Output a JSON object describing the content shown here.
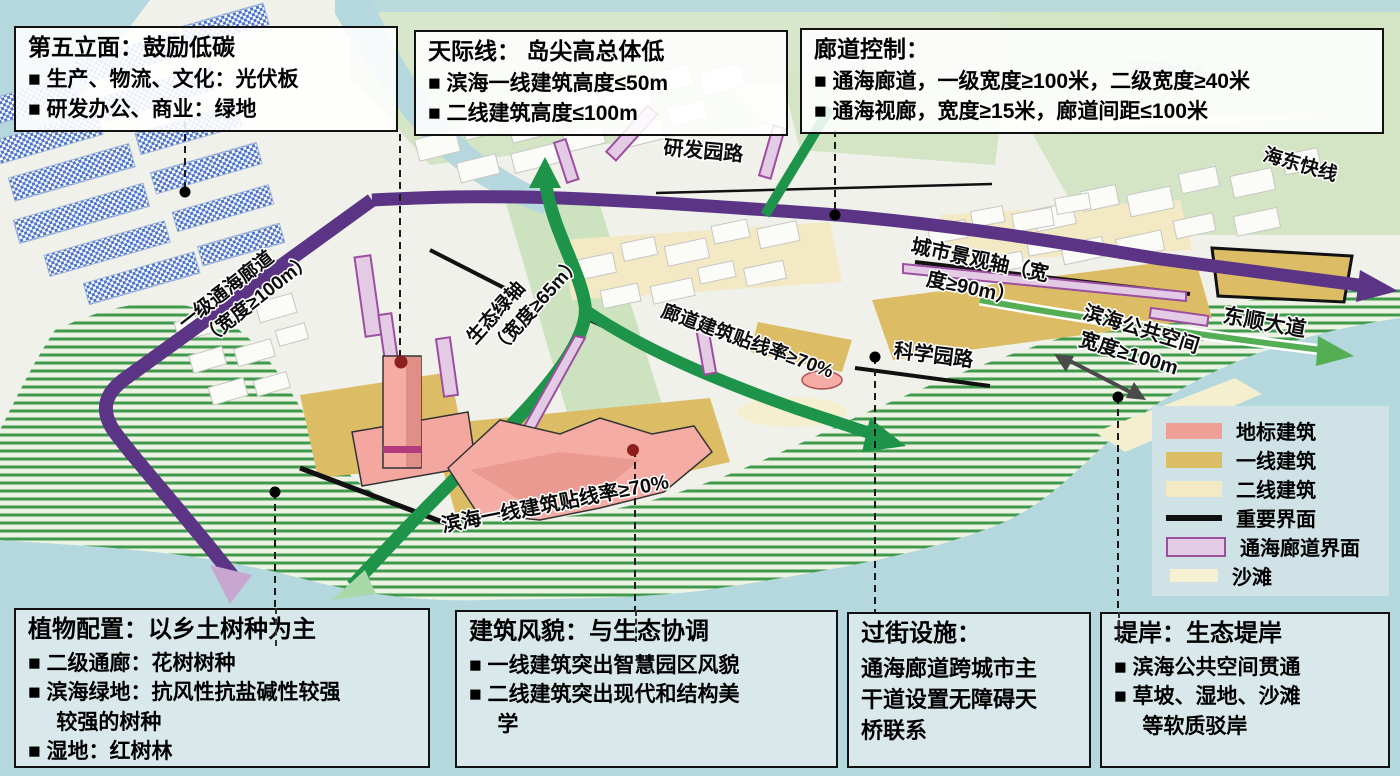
{
  "callouts": {
    "facade": {
      "title": "第五立面：鼓励低碳",
      "items": [
        "■ 生产、物流、文化：光伏板",
        "■ 研发办公、商业：绿地"
      ]
    },
    "skyline": {
      "title": "天际线： 岛尖高总体低",
      "items": [
        "■ 滨海一线建筑高度≤50m",
        "■ 二线建筑高度≤100m"
      ]
    },
    "corridor": {
      "title": "廊道控制：",
      "items": [
        "■ 通海廊道，一级宽度≥100米，二级宽度≥40米",
        "■ 通海视廊，宽度≥15米，廊道间距≤100米"
      ]
    },
    "plants": {
      "title": "植物配置：以乡土树种为主",
      "items": [
        "■ 二级通廊：花树树种",
        "■ 滨海绿地：抗风性抗盐碱性较强\n较强的树种",
        "■ 湿地：红树林"
      ]
    },
    "style": {
      "title": "建筑风貌：与生态协调",
      "items": [
        "■ 一线建筑突出智慧园区风貌",
        "■ 二线建筑突出现代和结构美\n学"
      ]
    },
    "crossing": {
      "title": "过街设施：",
      "body": "通海廊道跨城市主\n干道设置无障碍天\n桥联系"
    },
    "embankment": {
      "title": "堤岸：生态堤岸",
      "items": [
        "■ 滨海公共空间贯通",
        "■ 草坡、湿地、沙滩\n等软质驳岸"
      ]
    }
  },
  "legend": {
    "items": [
      {
        "label": "地标建筑",
        "color": "#ef9f96"
      },
      {
        "label": "一线建筑",
        "color": "#dcbd66"
      },
      {
        "label": "二线建筑",
        "color": "#f4e9c5"
      },
      {
        "label": "重要界面",
        "color": "#111111"
      },
      {
        "label": "通海廊道界面",
        "color": "#e3cbe6",
        "border": "#9c4f9e"
      },
      {
        "label": "沙滩",
        "color": "#f5f1d2"
      }
    ]
  },
  "map_labels": {
    "corridor_primary_1": "一级通海廊道",
    "corridor_primary_2": "（宽度≥100m）",
    "eco_axis_1": "生态绿轴",
    "eco_axis_2": "（宽度≥65m）",
    "corridor_building_rate": "廊道建筑贴线率≥70%",
    "seaside_building_rate": "滨海一线建筑贴线率≥70%",
    "city_axis_1": "城市景观轴（宽",
    "city_axis_2": "度≥90m）",
    "seaside_space_1": "滨海公共空间",
    "seaside_space_2": "宽度≥100m",
    "dongshun_avenue": "东顺大道",
    "haidong_expressway": "海东快线",
    "yanfa_road": "研发园路",
    "kexue_road": "科学园路",
    "tiaoshun_faint": "调顺快线"
  },
  "accents": {
    "corridor_purple": "#5b3486",
    "corridor_purple_light": "#c9a6cf",
    "green_axis": "#1d9449",
    "green_axis_light": "#a9d8a9",
    "road_green": "#54ae54"
  }
}
